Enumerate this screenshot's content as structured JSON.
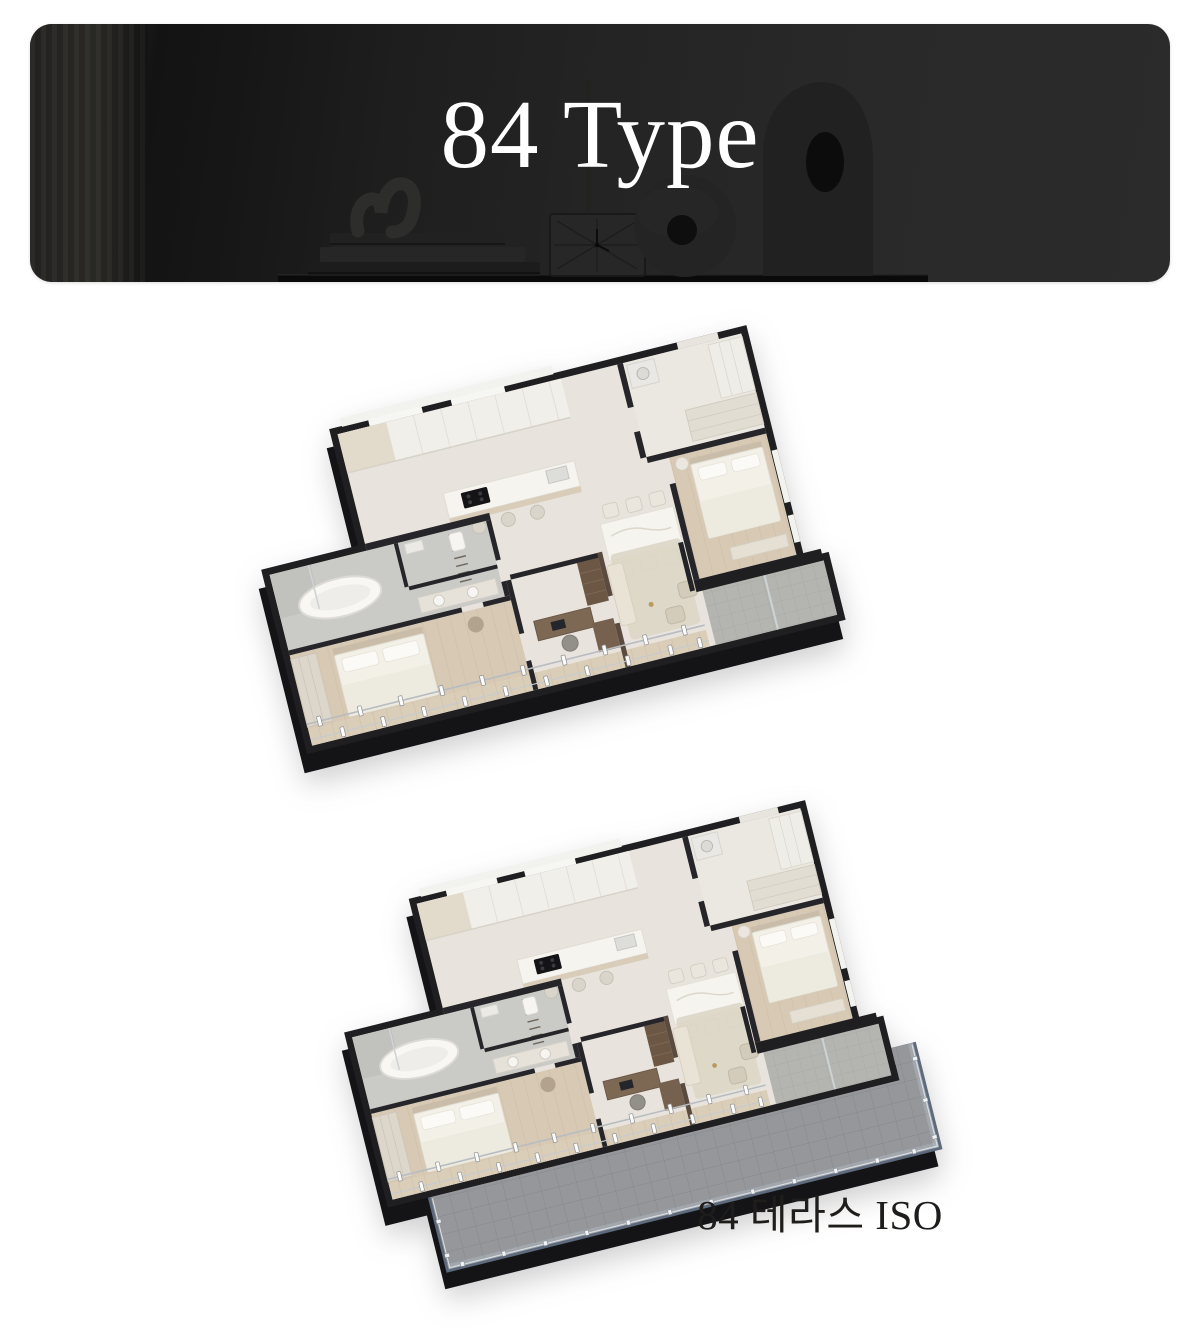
{
  "header": {
    "title": "84 Type"
  },
  "figures": {
    "iso": {
      "caption": ""
    },
    "terrace": {
      "caption": "84 테라스 ISO"
    }
  },
  "colors": {
    "page_background": "#ffffff",
    "banner_background": "#232221",
    "banner_title_text": "#ffffff",
    "caption_text": "#1e1d1b",
    "plan_wall": "#1f1f22",
    "plan_floor": "#e8e4dd",
    "plan_wood_floor": "#d7c9b3",
    "plan_bath_tile": "#cacac6",
    "terrace_tile": "#95979a",
    "terrace_railing": "#5c6a7c"
  }
}
